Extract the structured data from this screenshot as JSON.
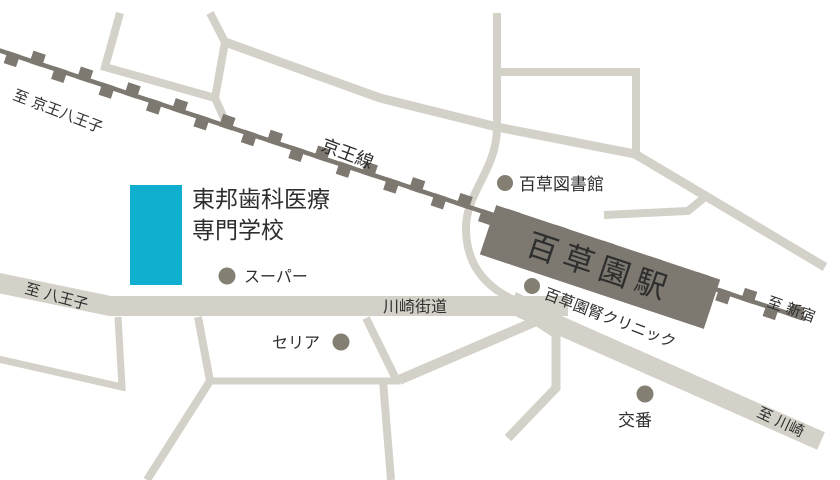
{
  "map": {
    "background_color": "#ffffff",
    "railway": {
      "line_name": "京王線",
      "color": "#7d7870",
      "left_destination": "至 京王八王子",
      "right_destination": "至 新宿"
    },
    "station": {
      "name": "百草園駅",
      "fill_color": "#7d7870",
      "text_color": "#ffffff"
    },
    "school": {
      "name_line1": "東邦歯科医療",
      "name_line2": "専門学校",
      "building_color": "#10afd0",
      "text_color": "#25abc8"
    },
    "roads": {
      "color": "#d4d1c9",
      "label_color": "#2e2e2e",
      "kawasaki_kaido_label": "川崎街道",
      "to_hachioji_label": "至 八王子",
      "to_kawasaki_label": "至 川崎"
    },
    "landmarks": {
      "marker_color": "#847f73",
      "library": {
        "label": "百草図書館"
      },
      "supermarket": {
        "label": "スーパー"
      },
      "seria": {
        "label": "セリア"
      },
      "clinic": {
        "label": "百草園腎クリニック"
      },
      "police_box": {
        "label": "交番"
      }
    }
  }
}
